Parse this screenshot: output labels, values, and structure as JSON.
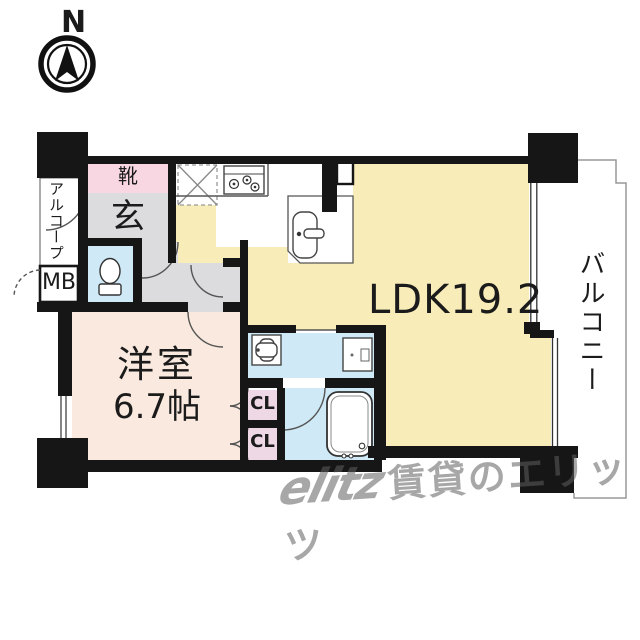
{
  "compass": {
    "north_label": "N"
  },
  "floor_plan": {
    "rooms": {
      "shoe_cabinet": "靴",
      "entrance": "玄",
      "alcove": "アルコープ",
      "meter_box": "MB",
      "western_room_name": "洋室",
      "western_room_size": "6.7帖",
      "ldk": "LDK19.2",
      "balcony": "バルコニー",
      "closet_upper": "CL",
      "closet_lower": "CL"
    },
    "colors": {
      "wall": "#161616",
      "ldk_fill": "#f8ecb8",
      "western_room_fill": "#f9e9de",
      "shoe_fill": "#f8d7e3",
      "wet_area_fill": "#cfe9f6",
      "closet_fill": "#efd8e6",
      "hall_fill": "#dcdcde"
    }
  },
  "watermark": {
    "logo": "elitz",
    "text": "賃貸のエリッツ"
  }
}
